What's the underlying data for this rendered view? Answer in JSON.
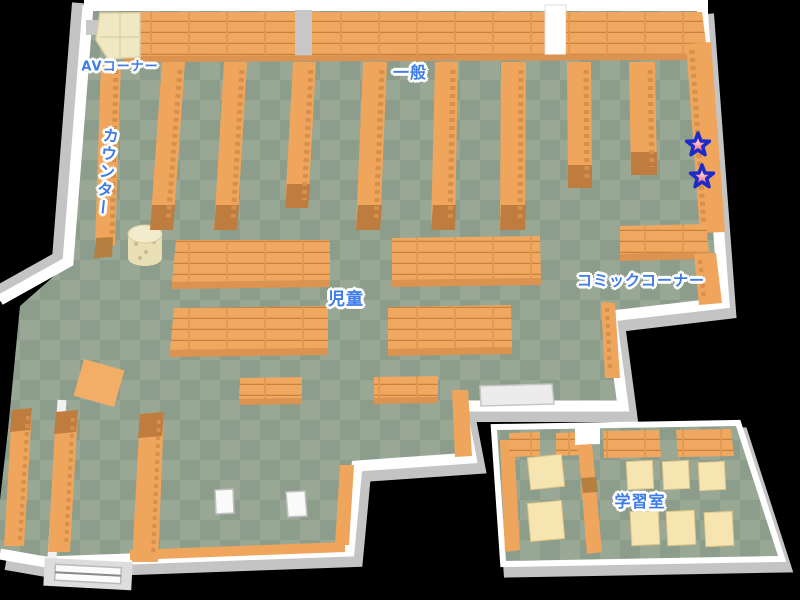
{
  "map": {
    "title": "Library floor map",
    "areas": [
      {
        "id": "av-corner",
        "label": "AVコーナー"
      },
      {
        "id": "general",
        "label": "一般"
      },
      {
        "id": "counter",
        "label": "カウンター"
      },
      {
        "id": "children",
        "label": "児童"
      },
      {
        "id": "comic-corner",
        "label": "コミックコーナー"
      },
      {
        "id": "study-room",
        "label": "学習室"
      }
    ],
    "markers": {
      "star_count": 2,
      "shape": "star"
    },
    "colors": {
      "label_blue": "#3d7ce8",
      "label_outline": "#ffffff",
      "shelf_orange": "#efa55c",
      "shelf_cap_brown": "#be7c3f",
      "floor_green_dark": "#8d9d8c",
      "floor_green_light": "#99a795",
      "wall_white": "#ffffff",
      "wall_gray": "#c4c4c4",
      "desk_cream": "#f6e5b0",
      "star_red": "#e63a49",
      "star_outline_blue": "#1c2bc9",
      "background": "#000000"
    }
  }
}
